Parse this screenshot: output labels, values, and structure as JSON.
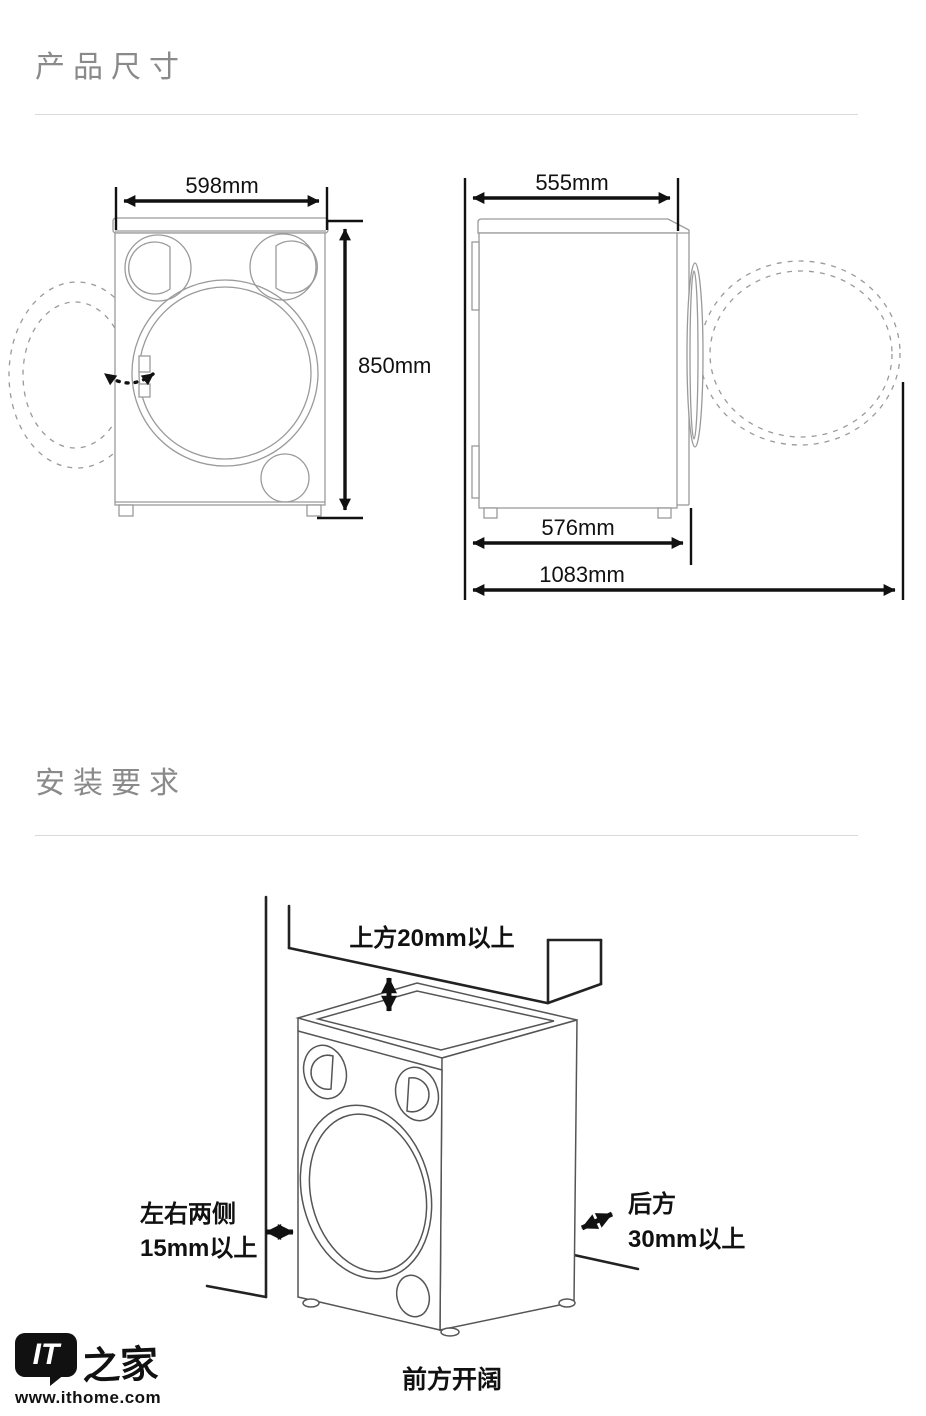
{
  "sections": {
    "product_dimensions": {
      "title": "产品尺寸",
      "front_view": {
        "width_label": "598mm",
        "height_label": "850mm"
      },
      "side_view": {
        "depth_label": "555mm",
        "body_depth_label": "576mm",
        "door_open_label": "1083mm"
      }
    },
    "installation": {
      "title": "安装要求",
      "clearances": {
        "top": "上方20mm以上",
        "sides_line1": "左右两侧",
        "sides_line2": "15mm以上",
        "rear_line1": "后方",
        "rear_line2": "30mm以上",
        "front": "前方开阔"
      }
    }
  },
  "footer": {
    "logo_it": "IT",
    "logo_home": "之家",
    "website": "www.ithome.com"
  },
  "colors": {
    "heading": "#8a8a8a",
    "divider": "#d9d9d9",
    "drawing_line": "#9a9a9a",
    "dimension_line": "#111111"
  }
}
